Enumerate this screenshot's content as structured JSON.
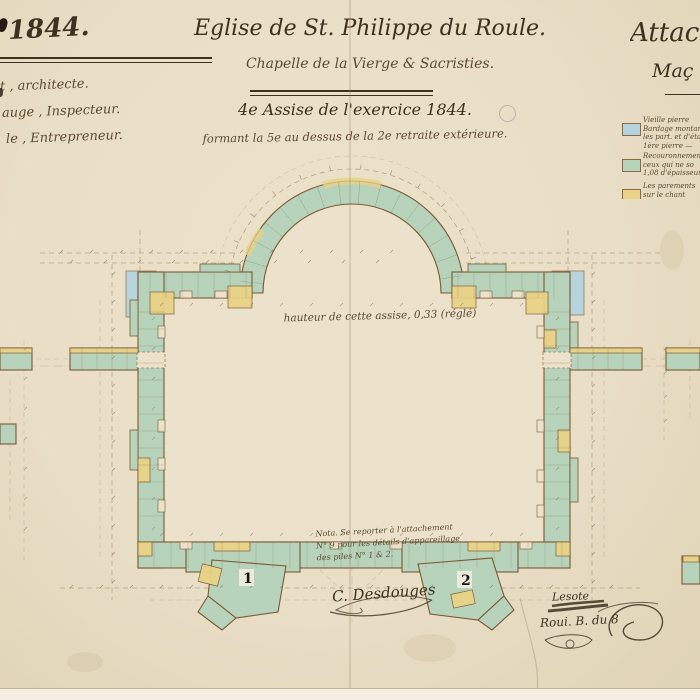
{
  "palette": {
    "paper": "#eadfc6",
    "paper_room": "#ece2cb",
    "paper_edge": "#f4efe2",
    "ink_dark": "#3f3020",
    "ink_mid": "#5d4a30",
    "wall_green": "#b7d3bc",
    "accent_yellow": "#e9d287",
    "accent_blue": "#b5d2df",
    "wall_outline": "#7a5a33",
    "dim_line": "#a28e68"
  },
  "header": {
    "left": {
      "year": "1844.",
      "credits": [
        "t , architecte.",
        "auge , Inspecteur.",
        "le , Entrepreneur."
      ]
    },
    "center": {
      "title": "Eglise de St. Philippe du Roule.",
      "subtitle": "Chapelle de la Vierge & Sacristies.",
      "course_line": "4e Assise de l'exercice 1844.",
      "detail_line": "formant la 5e au dessus de la 2e retraite extérieure."
    },
    "right": {
      "heading": "Attac",
      "subheading": "Maç",
      "legend": [
        {
          "color": "#b5d2df",
          "lines": [
            "Vieille pierre",
            "Bardage montant",
            "les part. et d'éta",
            "1ère pierre —"
          ]
        },
        {
          "color": "#b7d3bc",
          "lines": [
            "Recouronnement",
            "ceux qui ne so",
            "1,08 d'épaisseur"
          ]
        },
        {
          "color": "#e9d287",
          "lines": [
            "Les parements",
            "sur le chant"
          ]
        }
      ]
    }
  },
  "plan": {
    "center_note": "hauteur de cette assise, 0,33 (réglé)",
    "nota_lines": [
      "Nota. Se reporter à l'attachement",
      "N° 9 pour les détails d'appareillage",
      "des piles N° 1 & 2."
    ],
    "pier_labels": [
      "1",
      "2"
    ]
  },
  "signatures": {
    "architect": "C. Desdouges",
    "contractor": "Lesote",
    "approval": "Roui. B. du 8"
  }
}
